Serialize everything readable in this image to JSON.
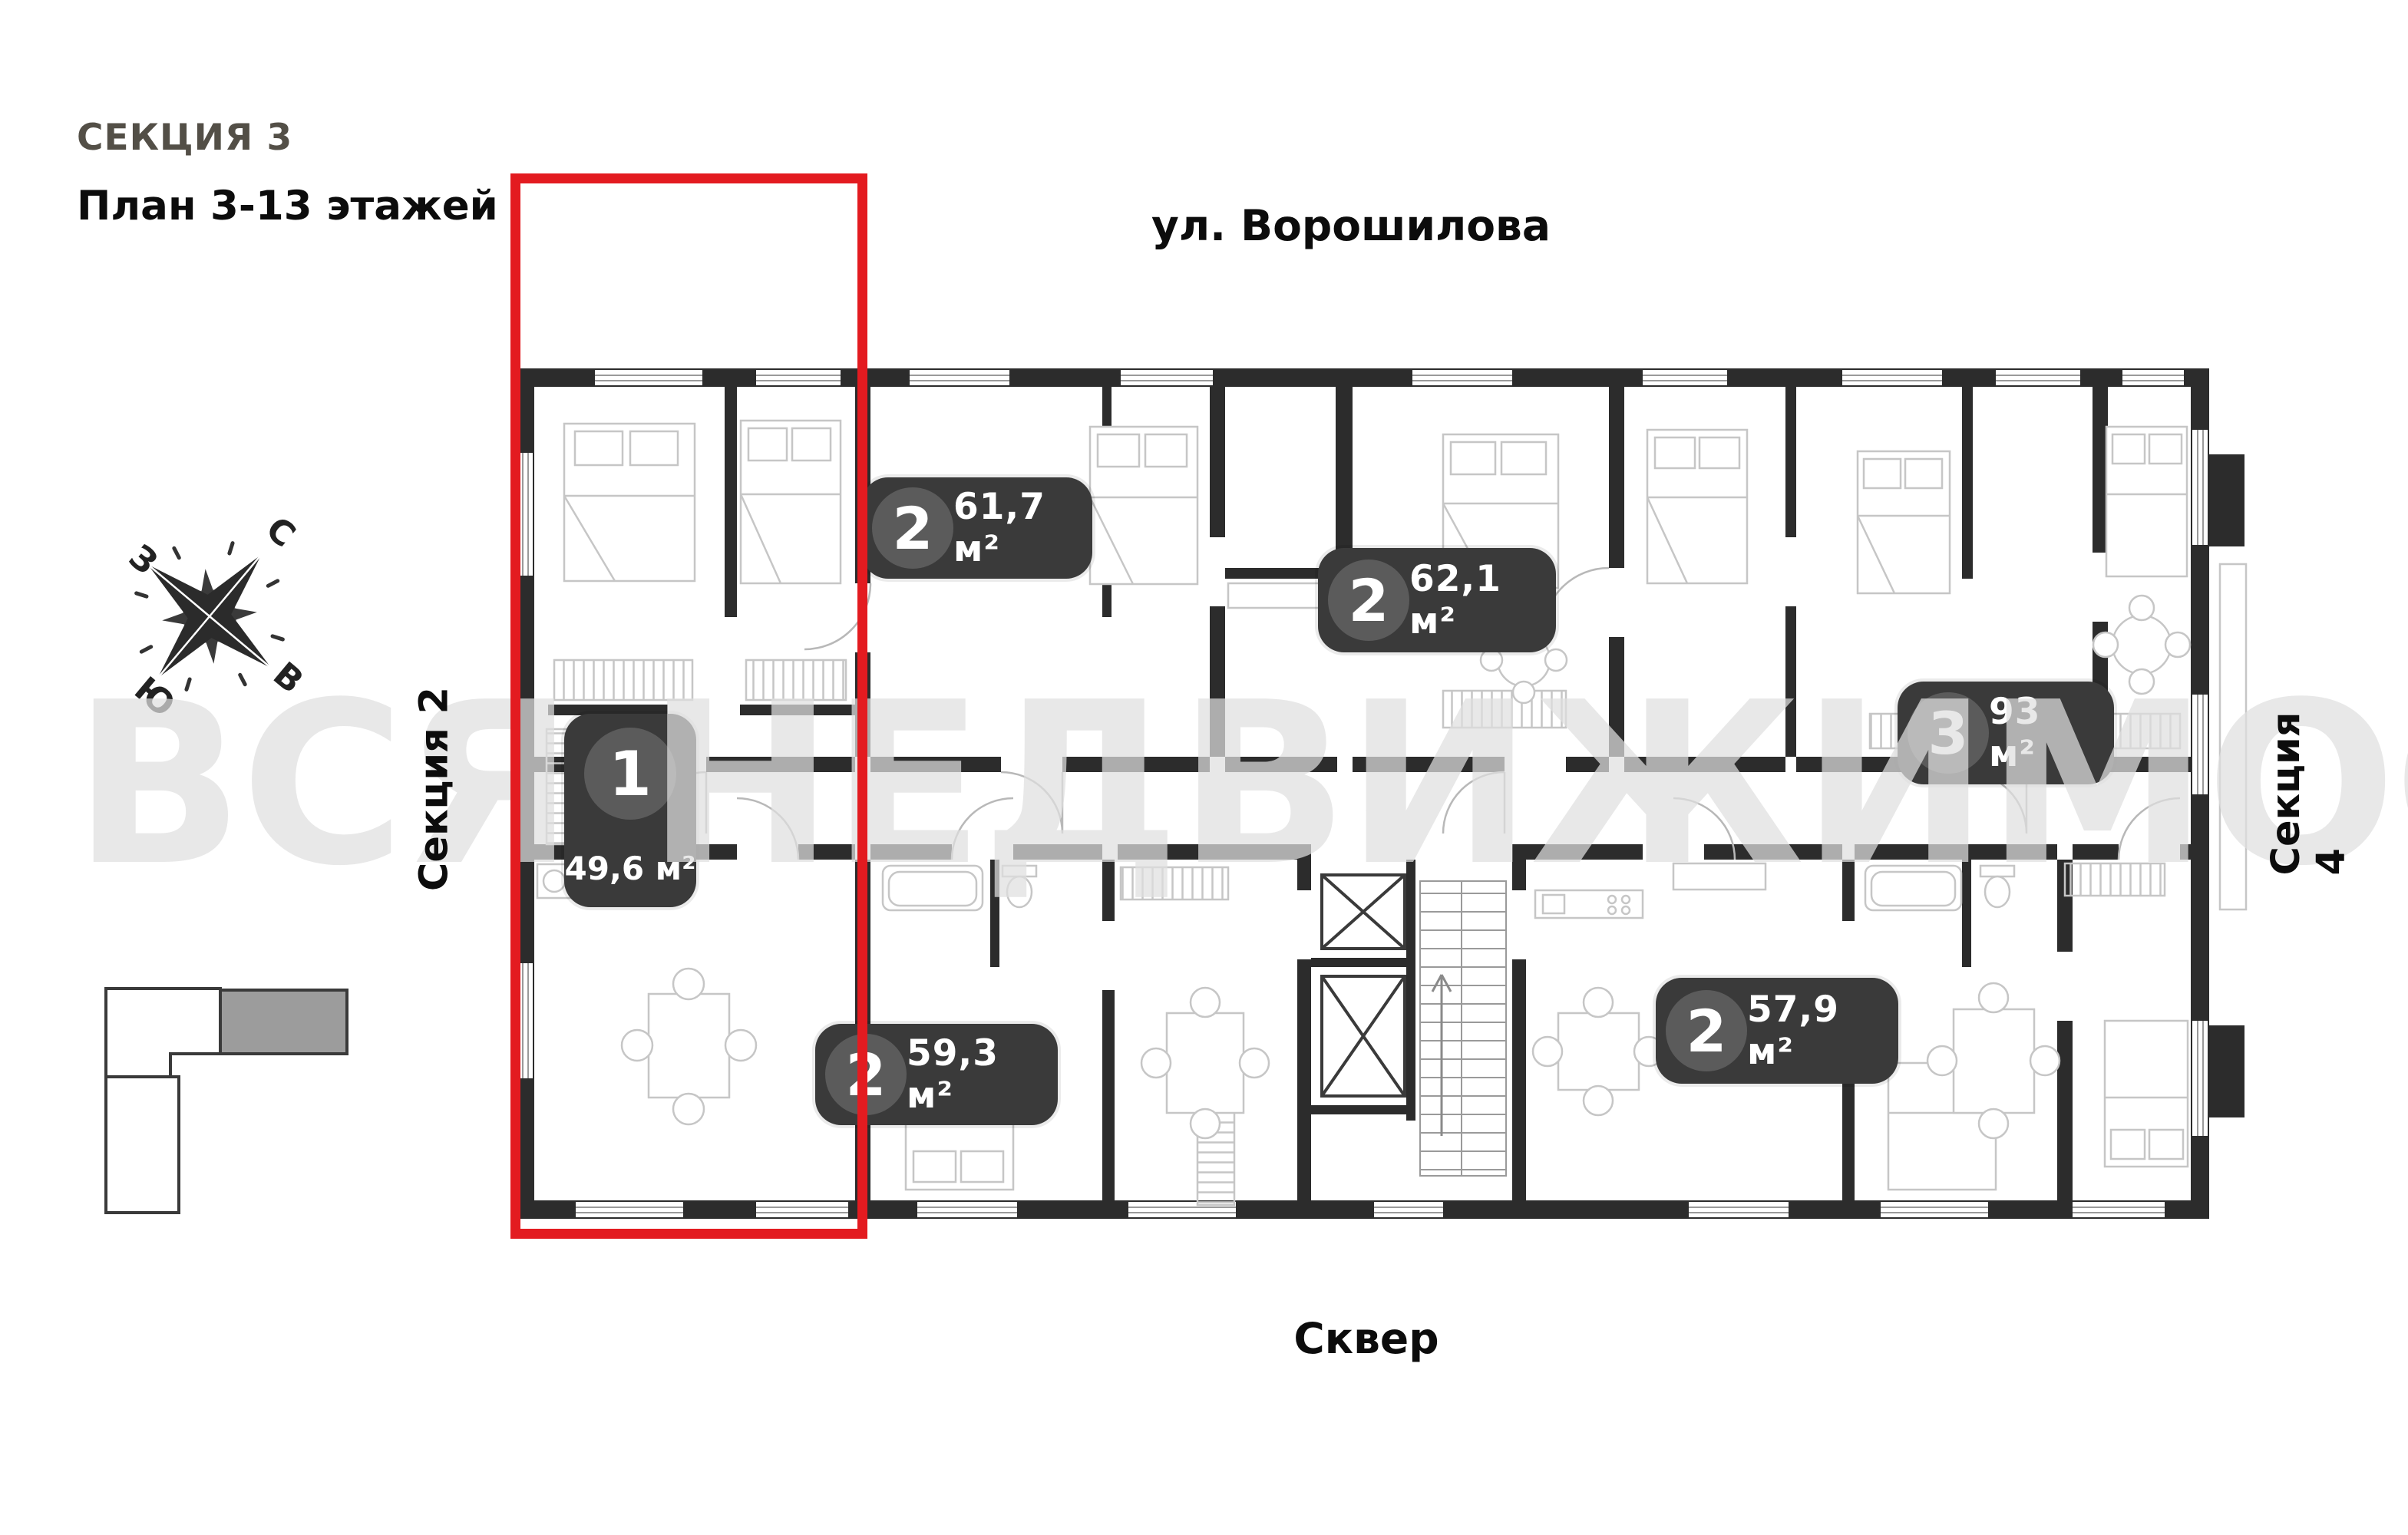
{
  "header": {
    "section_title": "СЕКЦИЯ 3",
    "plan_subtitle": "План 3-13 этажей"
  },
  "labels": {
    "street": "ул. Ворошилова",
    "square": "Сквер",
    "section_left": "Секция 2",
    "section_right": "Секция 4"
  },
  "compass": {
    "north": "С",
    "east": "В",
    "south": "Ю",
    "west": "З"
  },
  "watermark": "ВСЯ НЕДВИЖИМОСТЬ",
  "apartments": [
    {
      "rooms": "1",
      "area": "49,6 м²",
      "highlighted": true
    },
    {
      "rooms": "2",
      "area": "61,7 м²",
      "highlighted": false
    },
    {
      "rooms": "2",
      "area": "62,1 м²",
      "highlighted": false
    },
    {
      "rooms": "3",
      "area": "93 м²",
      "highlighted": false
    },
    {
      "rooms": "2",
      "area": "59,3 м²",
      "highlighted": false
    },
    {
      "rooms": "2",
      "area": "57,9 м²",
      "highlighted": false
    }
  ],
  "colors": {
    "highlight_red": "#e31b20",
    "wall": "#2c2c2c",
    "badge_bg": "#3a3a3a",
    "badge_circle": "#5b5b5b",
    "minimap_gray": "#9c9c9c",
    "furniture_line": "#c6c6c6"
  }
}
